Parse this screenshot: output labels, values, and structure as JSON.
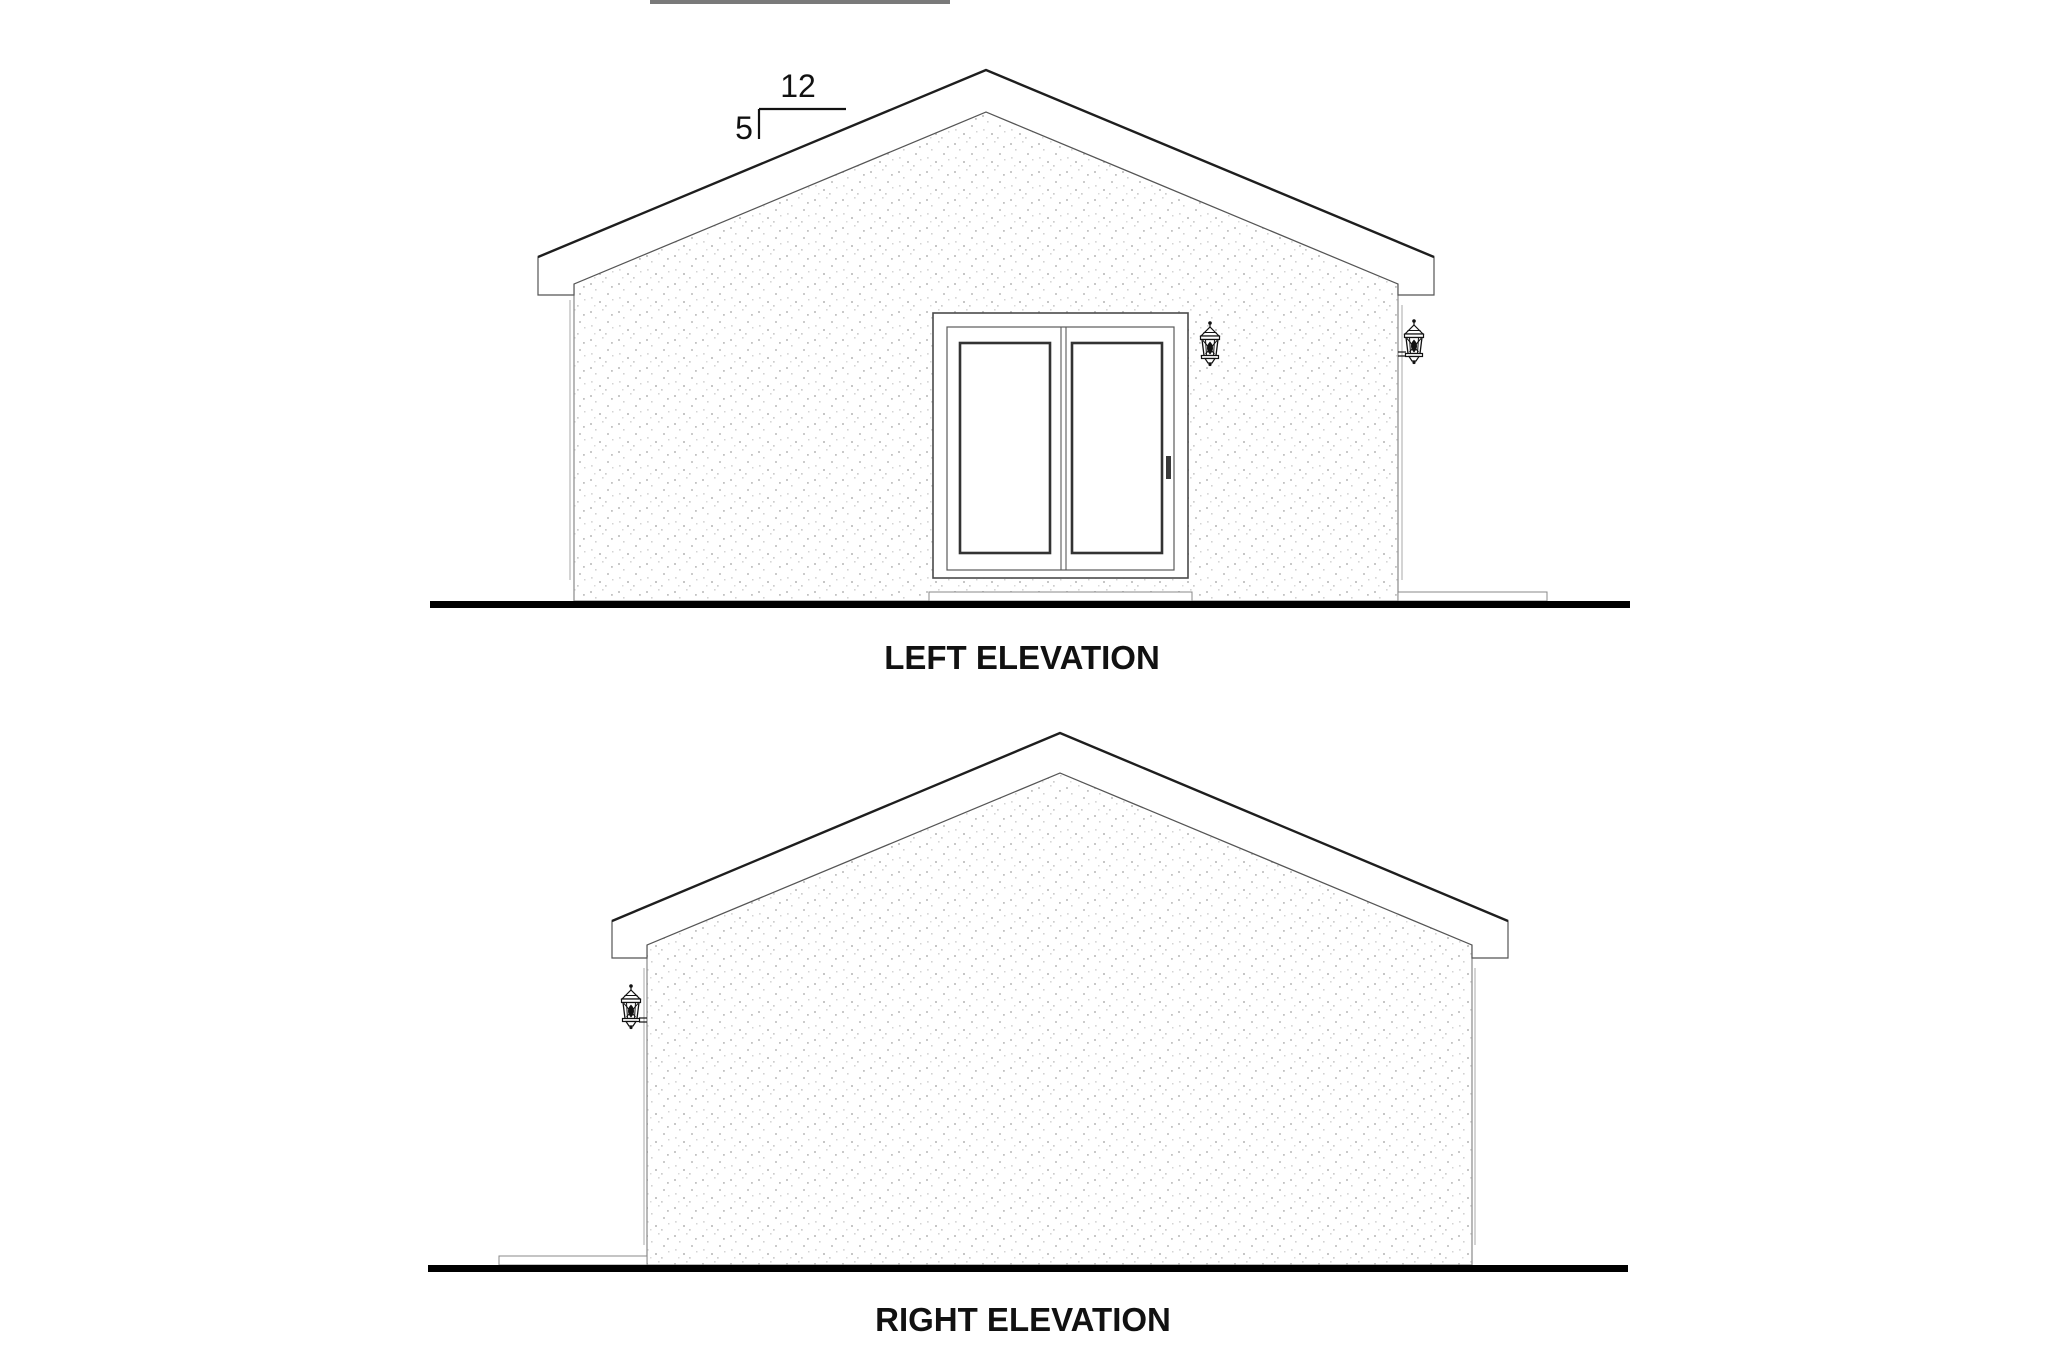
{
  "sheet": {
    "background": "#ffffff",
    "edge_artifact_color": "#7a7a7a"
  },
  "colors": {
    "ink": "#111111",
    "drawing_line": "#555555",
    "light_line": "#909090",
    "ground_line": "#000000",
    "wall_fill": "#ffffff"
  },
  "left_elevation": {
    "label": "LEFT ELEVATION",
    "roof_pitch": {
      "run": "12",
      "rise": "5"
    }
  },
  "right_elevation": {
    "label": "RIGHT ELEVATION"
  },
  "icons": {
    "wall_lantern": "wall-lantern-icon"
  }
}
